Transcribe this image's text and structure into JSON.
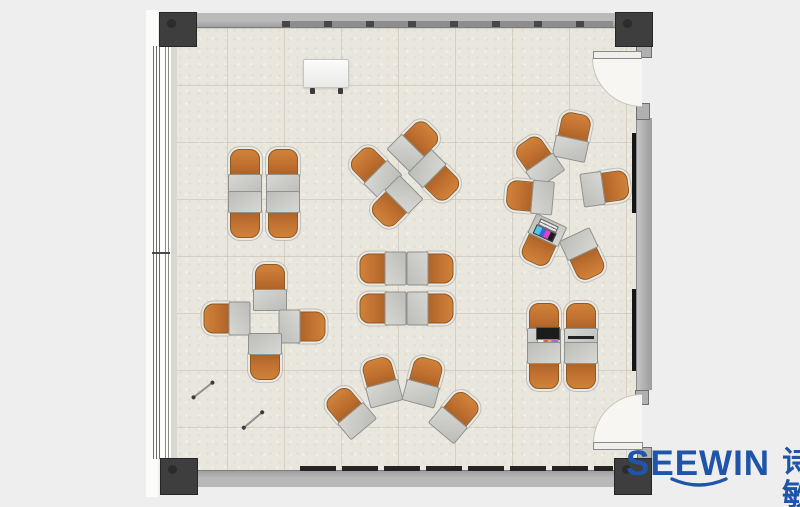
{
  "brand": {
    "wordmark": "SEEWIN",
    "cjk": "诗敏",
    "color": "#1e55a8"
  },
  "palette": {
    "brand": "#1e55a8",
    "floor": "#e9e6de",
    "wall": "#a8a8a8",
    "column": "#3e3e3e",
    "chair": "#c07030",
    "desk": "#bcbcb8",
    "swing": "#f7f6f2"
  },
  "furniture": {
    "clusters": [
      "quad-top-left",
      "quad-rotated-top-middle",
      "circle-of-six-right",
      "pinwheel-left-middle",
      "quad-center",
      "arc-of-four-bottom",
      "quad-bottom-right"
    ],
    "units": [
      {
        "c": "quad-top-left",
        "x": 245,
        "y": 172,
        "r": 0
      },
      {
        "c": "quad-top-left",
        "x": 283,
        "y": 172,
        "r": 0
      },
      {
        "c": "quad-top-left",
        "x": 245,
        "y": 214,
        "r": 180
      },
      {
        "c": "quad-top-left",
        "x": 283,
        "y": 214,
        "r": 180
      },
      {
        "c": "quad-rotated-top-middle",
        "x": 374,
        "y": 170,
        "r": -45
      },
      {
        "c": "quad-rotated-top-middle",
        "x": 415,
        "y": 144,
        "r": 45
      },
      {
        "c": "quad-rotated-top-middle",
        "x": 436,
        "y": 177,
        "r": 135
      },
      {
        "c": "quad-rotated-top-middle",
        "x": 395,
        "y": 203,
        "r": 225
      },
      {
        "c": "circle-of-six-right",
        "x": 573,
        "y": 136,
        "r": 12
      },
      {
        "c": "circle-of-six-right",
        "x": 538,
        "y": 160,
        "r": -35
      },
      {
        "c": "circle-of-six-right",
        "x": 530,
        "y": 196,
        "r": -85
      },
      {
        "c": "circle-of-six-right",
        "x": 542,
        "y": 241,
        "r": 205,
        "prop": "laptop_color"
      },
      {
        "c": "circle-of-six-right",
        "x": 584,
        "y": 255,
        "r": 155
      },
      {
        "c": "circle-of-six-right",
        "x": 605,
        "y": 187,
        "r": 82
      },
      {
        "c": "pinwheel-left-middle",
        "x": 270,
        "y": 287,
        "r": 0
      },
      {
        "c": "pinwheel-left-middle",
        "x": 227,
        "y": 318,
        "r": -90
      },
      {
        "c": "pinwheel-left-middle",
        "x": 302,
        "y": 326,
        "r": 90
      },
      {
        "c": "pinwheel-left-middle",
        "x": 265,
        "y": 356,
        "r": 180
      },
      {
        "c": "quad-center",
        "x": 383,
        "y": 268,
        "r": -90
      },
      {
        "c": "quad-center",
        "x": 430,
        "y": 268,
        "r": 90
      },
      {
        "c": "quad-center",
        "x": 383,
        "y": 308,
        "r": -90
      },
      {
        "c": "quad-center",
        "x": 430,
        "y": 308,
        "r": 90
      },
      {
        "c": "arc-of-four-bottom",
        "x": 349,
        "y": 411,
        "r": -40
      },
      {
        "c": "arc-of-four-bottom",
        "x": 381,
        "y": 381,
        "r": -15
      },
      {
        "c": "arc-of-four-bottom",
        "x": 424,
        "y": 381,
        "r": 15
      },
      {
        "c": "arc-of-four-bottom",
        "x": 456,
        "y": 415,
        "r": 40
      },
      {
        "c": "quad-bottom-right",
        "x": 544,
        "y": 326,
        "r": 0,
        "prop": "laptop_book"
      },
      {
        "c": "quad-bottom-right",
        "x": 581,
        "y": 326,
        "r": 0,
        "prop": "bar"
      },
      {
        "c": "quad-bottom-right",
        "x": 544,
        "y": 365,
        "r": 180
      },
      {
        "c": "quad-bottom-right",
        "x": 581,
        "y": 365,
        "r": 180
      }
    ]
  },
  "objects": {
    "whiteboard": {
      "x": 303,
      "y": 59,
      "w": 44,
      "h": 27
    },
    "floor_sticks": [
      {
        "x": 191,
        "y": 389,
        "r": -38
      },
      {
        "x": 241,
        "y": 419,
        "r": -40
      }
    ]
  }
}
